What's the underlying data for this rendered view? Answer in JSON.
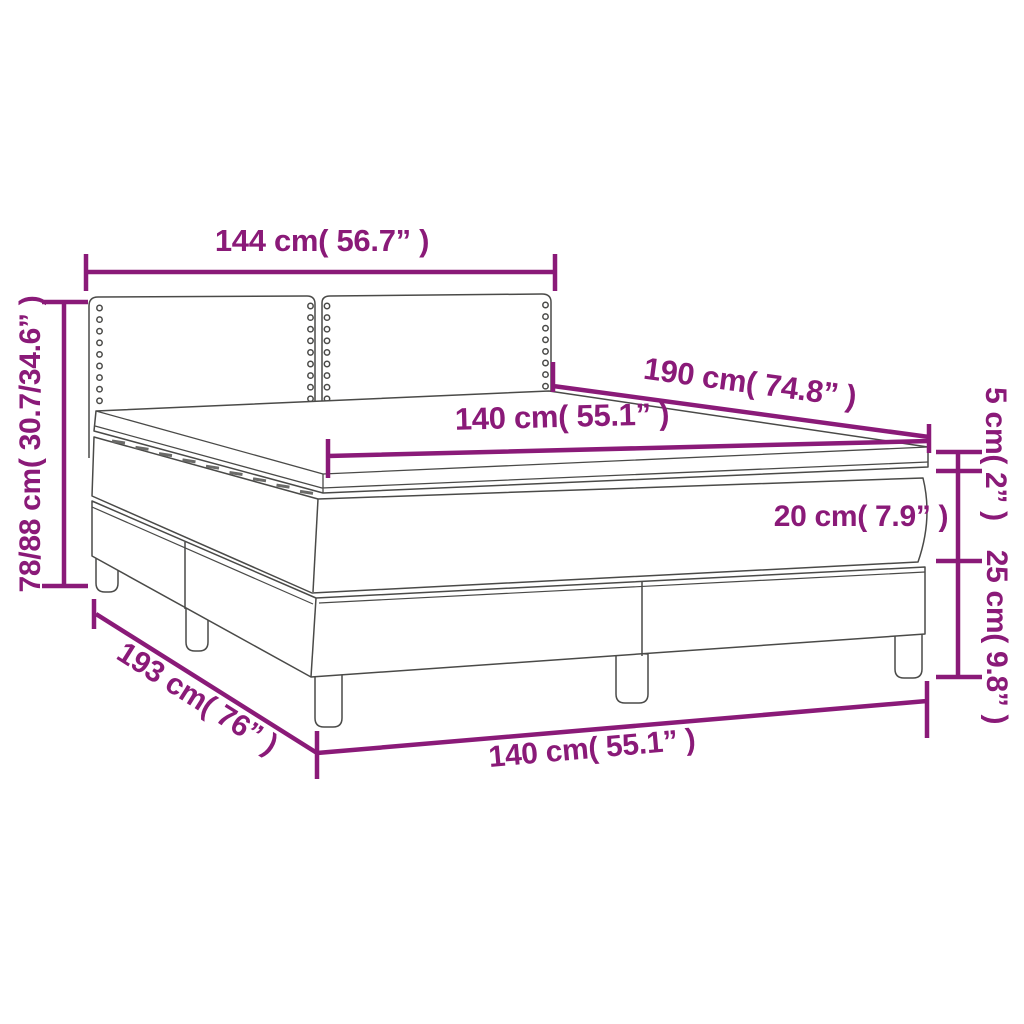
{
  "page": {
    "background": "#ffffff",
    "accent_color": "#8A1A78",
    "drawing_line_color": "#4a4a48"
  },
  "product": {
    "name": "Box spring bed with headboard, mattress and topper — dimension diagram"
  },
  "dimensions": [
    {
      "id": "headboard-width",
      "text": "144 cm( 56.7” )"
    },
    {
      "id": "overall-height",
      "text": "78/88 cm( 30.7/34.6” )"
    },
    {
      "id": "mattress-length",
      "text": "190 cm( 74.8” )"
    },
    {
      "id": "mattress-width",
      "text": "140 cm( 55.1” )"
    },
    {
      "id": "topper-thickness",
      "text": "5 cm( 2” )"
    },
    {
      "id": "mattress-thickness",
      "text": "20 cm( 7.9” )"
    },
    {
      "id": "base-height",
      "text": "25 cm( 9.8” )"
    },
    {
      "id": "base-length",
      "text": "193 cm( 76” )"
    },
    {
      "id": "base-width",
      "text": "140 cm( 55.1” )"
    }
  ]
}
